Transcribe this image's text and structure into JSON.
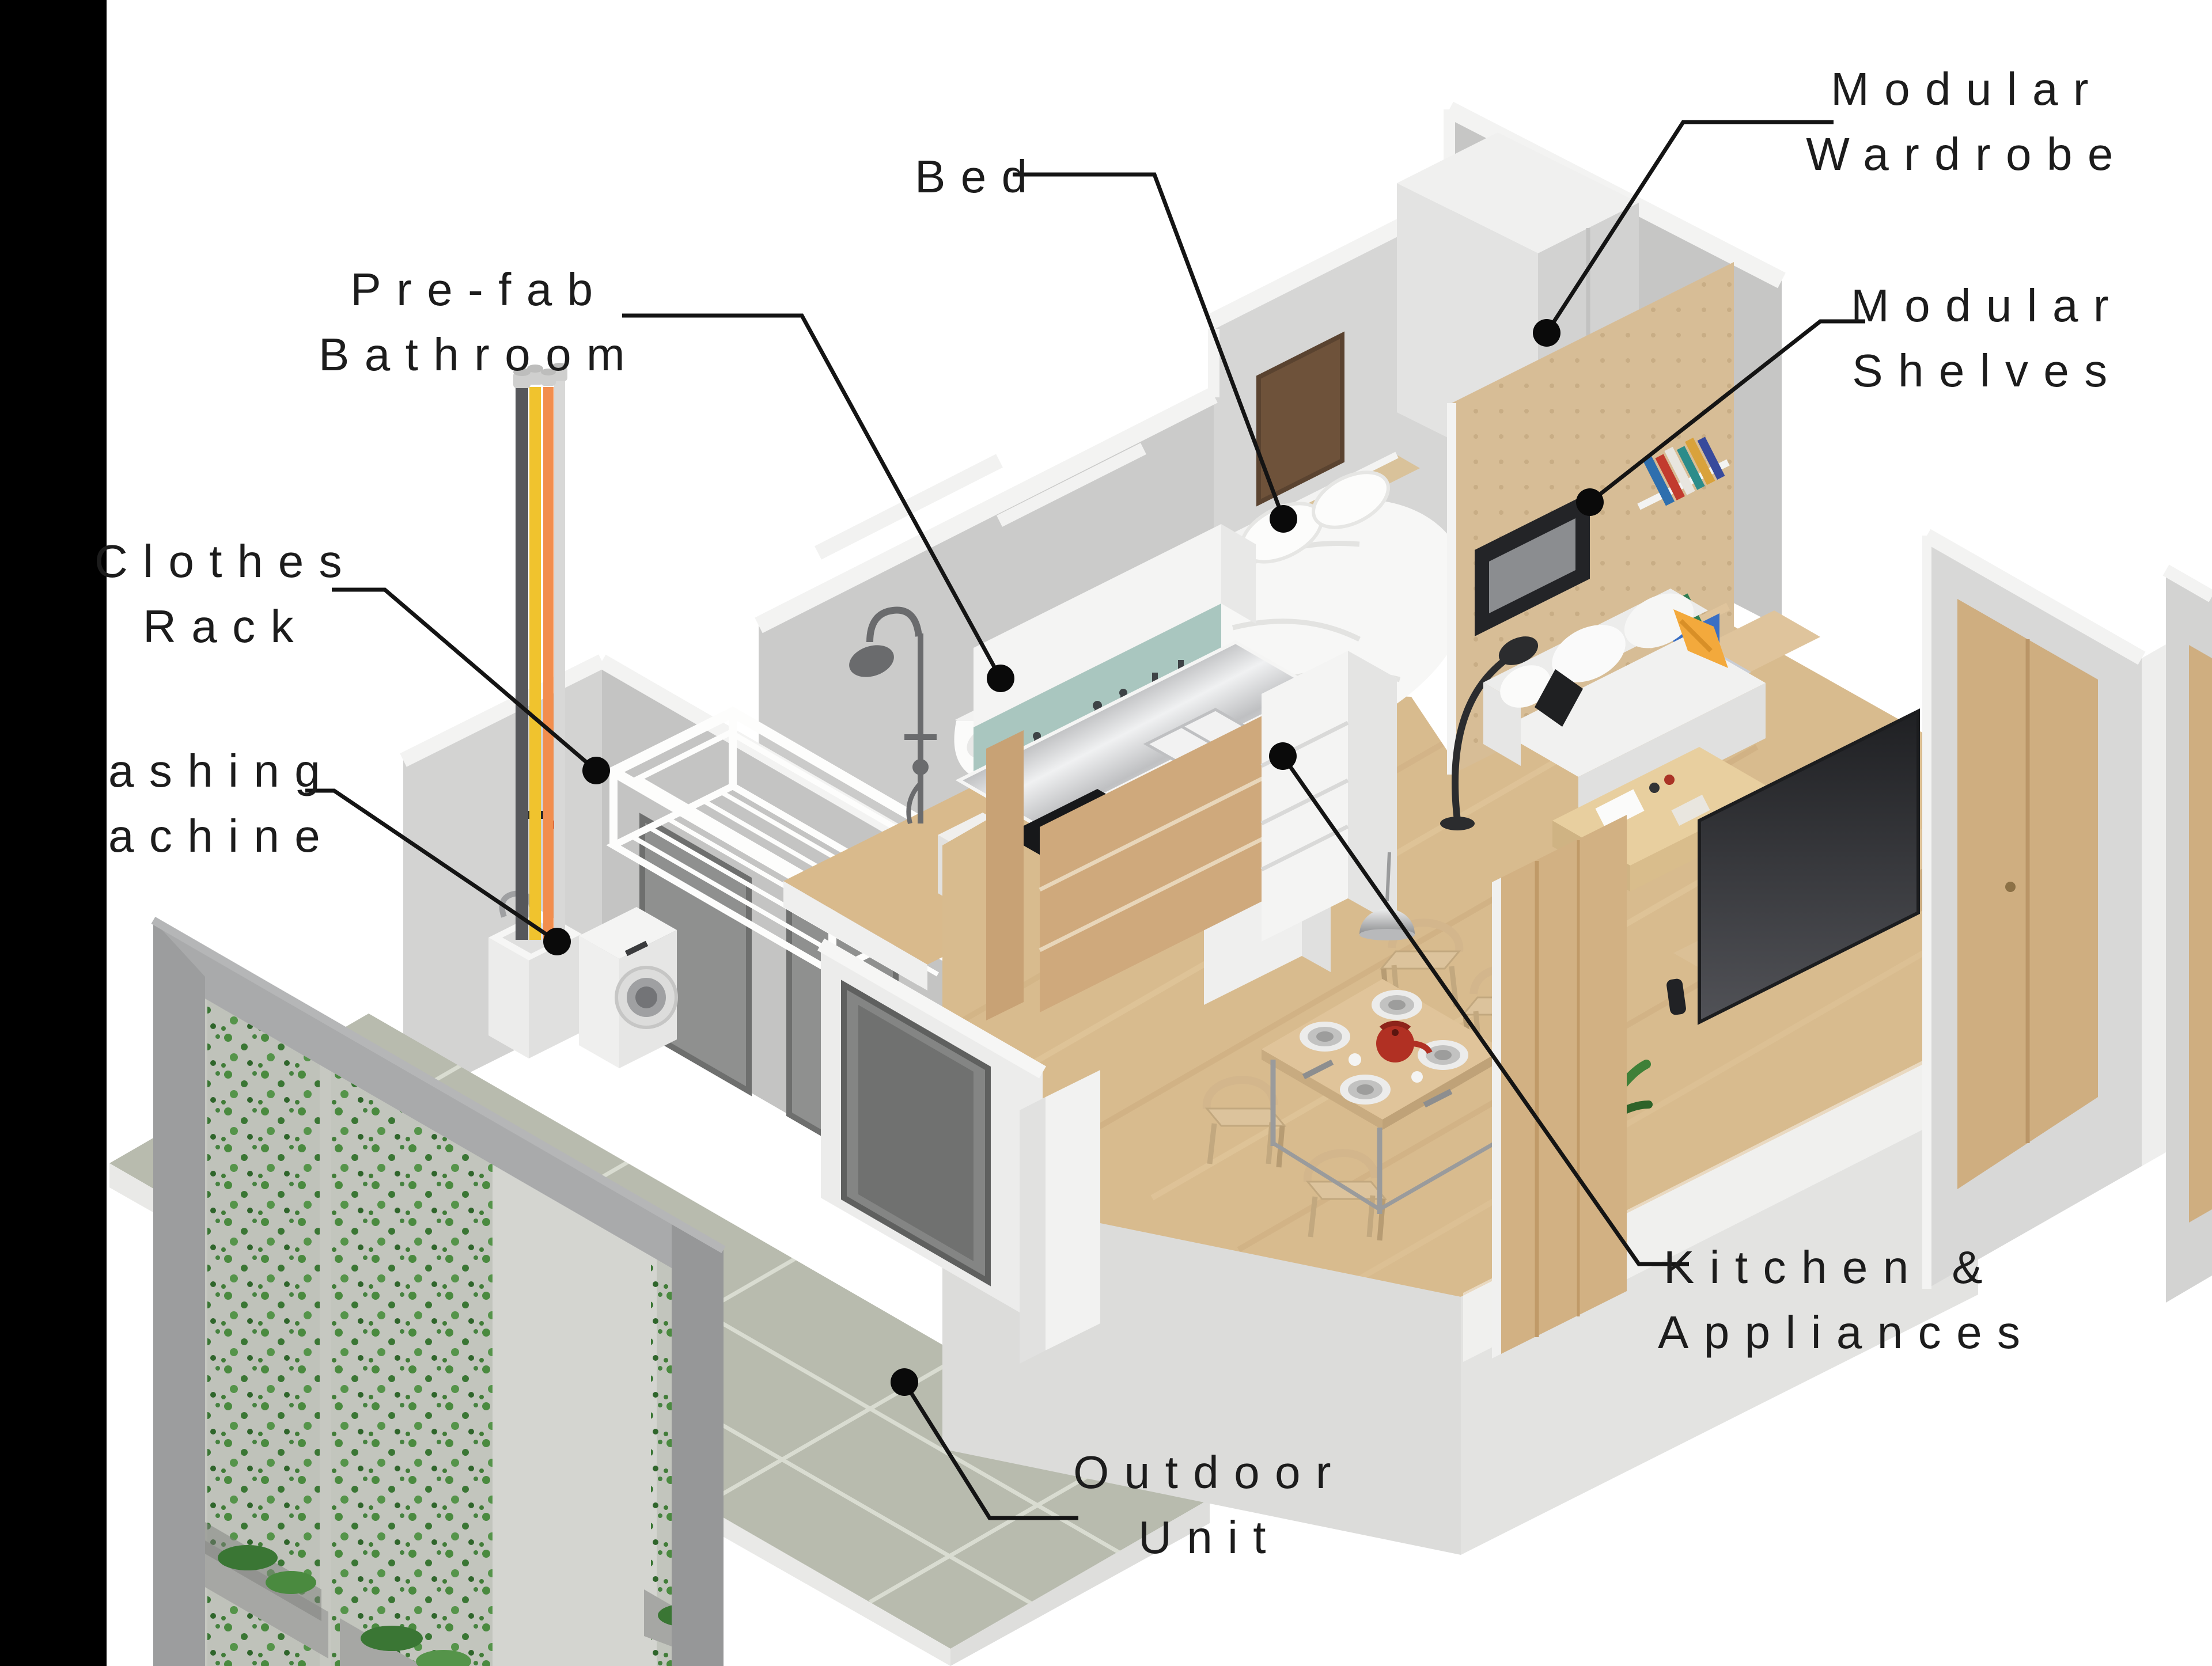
{
  "title": "Exploded isometric diagram of a modular micro-apartment",
  "labels": {
    "wardrobe": {
      "line1": "Modular",
      "line2": "Wardrobe"
    },
    "shelves": {
      "line1": "Modular",
      "line2": "Shelves"
    },
    "bed": {
      "line1": "Bed"
    },
    "prefab_bathroom": {
      "line1": "Pre-fab",
      "line2": "Bathroom"
    },
    "clothes_rack": {
      "line1": "Clothes",
      "line2": "Rack"
    },
    "washing_machine": {
      "line1": "ashing",
      "line2": "achine"
    },
    "kitchen": {
      "line1": "Kitchen &",
      "line2": "Appliances"
    },
    "outdoor_unit": {
      "line1": "Outdoor",
      "line2": "Unit"
    }
  },
  "colors": {
    "background": "#ffffff",
    "left_bar": "#000000",
    "label_text": "#1c1c1c",
    "leader_line": "#141414",
    "wall_gray": "#c9c9c8",
    "wall_light": "#dcdcdb",
    "trim_white": "#f3f3f2",
    "wood_floor": "#d8bb8e",
    "pegboard_wood": "#d7bd96",
    "door_wood": "#cfae80",
    "tile_floor": "#b8bbae",
    "teal_backsplash": "#a9c6bf",
    "steel_counter": "#cfd0d2",
    "pipe_dark": "#56575b",
    "pipe_yellow": "#f0c32e",
    "pipe_orange": "#f28e4e",
    "accent_yellow_pillow": "#f3a93c",
    "kettle_red": "#b13023",
    "plant_green": "#468240",
    "tv_dark": "#2c2d30"
  },
  "scene": {
    "parts": [
      "modular-wardrobe",
      "modular-shelves",
      "bed",
      "pre-fab-bathroom",
      "shower",
      "toilet",
      "clothes-rack",
      "washing-machine",
      "laundry-sink",
      "service-pipes",
      "kitchen-counter",
      "refrigerator",
      "dining-table",
      "dining-chairs",
      "pendant-lamp",
      "sofa",
      "floor-lamp",
      "coffee-table",
      "tv",
      "media-bench",
      "plant",
      "outdoor-unit-green-wall",
      "tiled-floor",
      "wood-floor",
      "entry-sliding-door",
      "right-wall-door-panel"
    ]
  }
}
